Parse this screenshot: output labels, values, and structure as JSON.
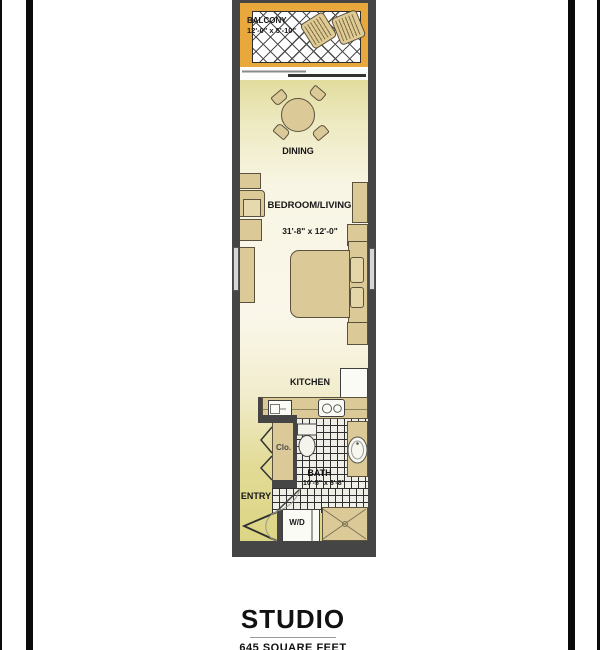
{
  "page": {
    "title": "STUDIO",
    "subtitle": "645 SQUARE FEET"
  },
  "rooms": {
    "balcony": {
      "label": "BALCONY",
      "dims": "12'-0\" x 5'-10\""
    },
    "dining": {
      "label": "DINING"
    },
    "bedroom": {
      "label": "BEDROOM/LIVING",
      "dims": "31'-8\" x 12'-0\""
    },
    "kitchen": {
      "label": "KITCHEN"
    },
    "closet": {
      "label": "Clo."
    },
    "bath": {
      "label": "BATH",
      "dims": "10'-5\" x 6'-8\""
    },
    "entry": {
      "label": "ENTRY"
    },
    "laundry": {
      "label": "W/D"
    }
  },
  "fixtures": {
    "balcony_chairs": "patio-chair-icon",
    "dining_table": "round-dining-table-icon",
    "bed": "bed-icon",
    "toilet": "toilet-icon",
    "bath_sink": "oval-sink-icon",
    "bathtub": "bathtub-icon",
    "kitchen_sink": "kitchen-sink-icon",
    "stove": "stove-burners-icon",
    "refrigerator": "refrigerator-icon",
    "washer_dryer": "washer-dryer-icon",
    "entry_door": "door-swing-icon",
    "bath_door": "door-swing-icon",
    "closet_doors": "bifold-door-icon",
    "balcony_door": "sliding-door-icon"
  },
  "colors": {
    "wall": "#454545",
    "balcony": "#E9A83C",
    "tan": "#DCC998",
    "tanline": "#5a523c",
    "green": "#D5CD7A",
    "cream": "#F8F5E4",
    "tile": "#EFEFE8",
    "ink": "#161616"
  }
}
